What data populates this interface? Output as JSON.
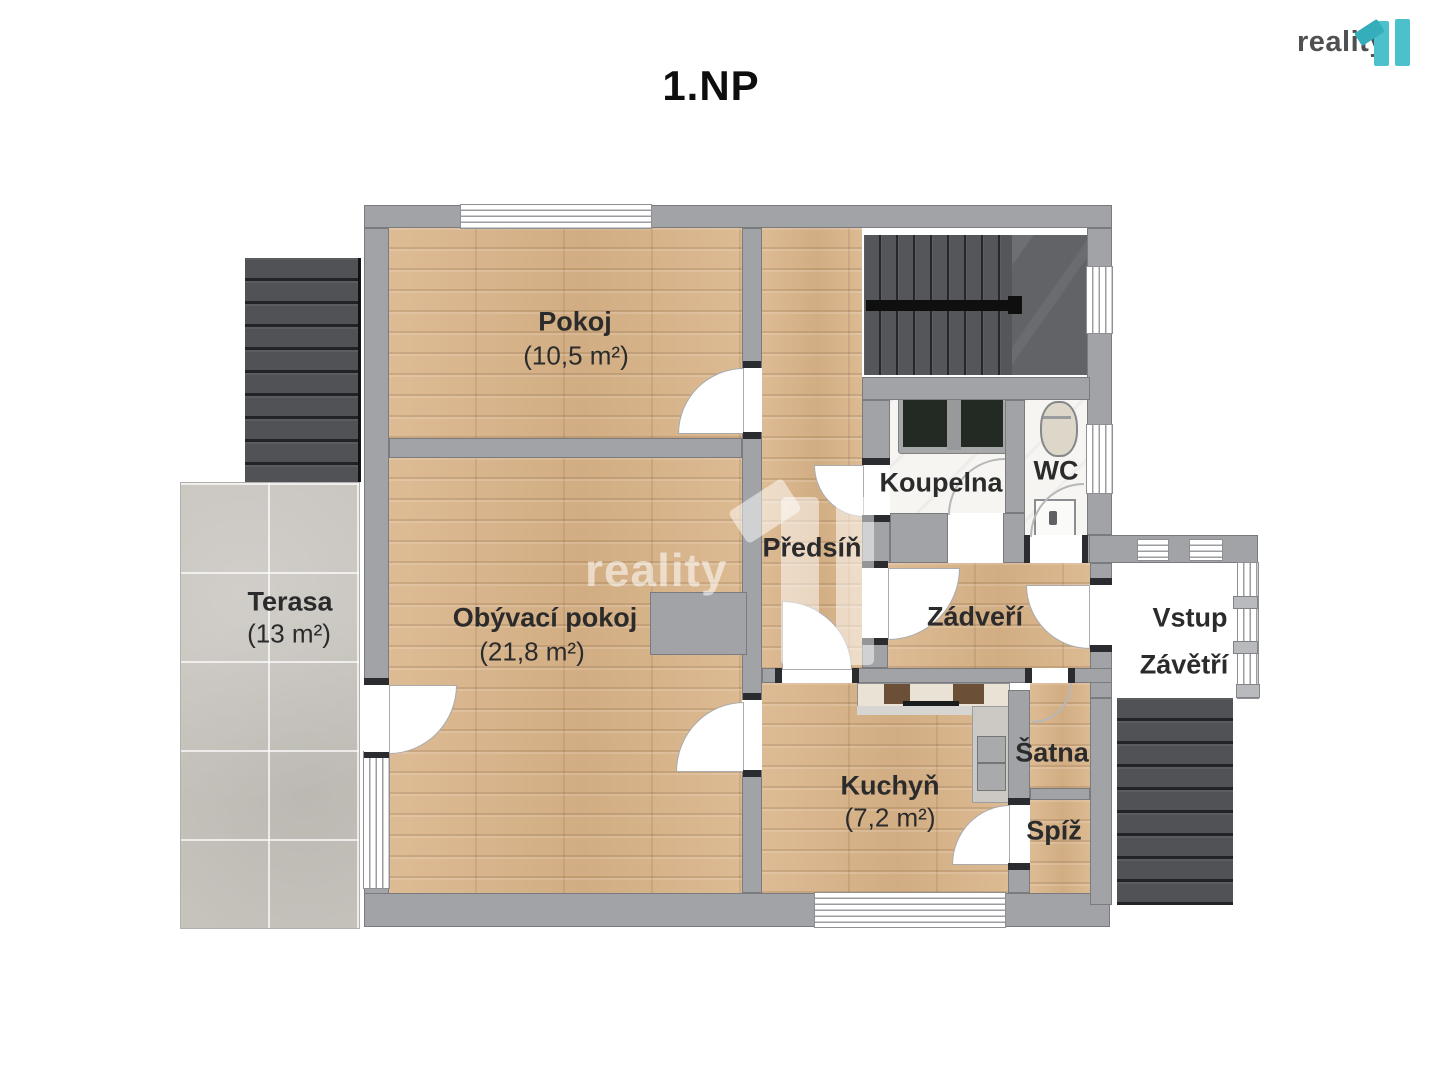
{
  "title": "1.NP",
  "brand": {
    "name": "reality",
    "suffix": "11"
  },
  "watermark": {
    "text": "reality"
  },
  "rooms": [
    {
      "name": "Pokoj",
      "area": "(10,5 m²)"
    },
    {
      "name": "Obývací pokoj",
      "area": "(21,8 m²)"
    },
    {
      "name": "Terasa",
      "area": "(13 m²)"
    },
    {
      "name": "Kuchyň",
      "area": "(7,2 m²)"
    },
    {
      "name": "Předsíň"
    },
    {
      "name": "Koupelna"
    },
    {
      "name": "WC"
    },
    {
      "name": "Zádveří"
    },
    {
      "name": "Vstup"
    },
    {
      "name": "Závětří"
    },
    {
      "name": "Šatna"
    },
    {
      "name": "Spíž"
    }
  ],
  "colors": {
    "accent_teal": "#4cc1cb",
    "wall_gray": "#a1a3a6",
    "wood_floor": "#d9b58b",
    "terrace_tile": "#c7c3bd",
    "stairs_dark": "#55565a",
    "bath_marble": "#f6f5f2",
    "label_text": "#2b2b2c"
  }
}
